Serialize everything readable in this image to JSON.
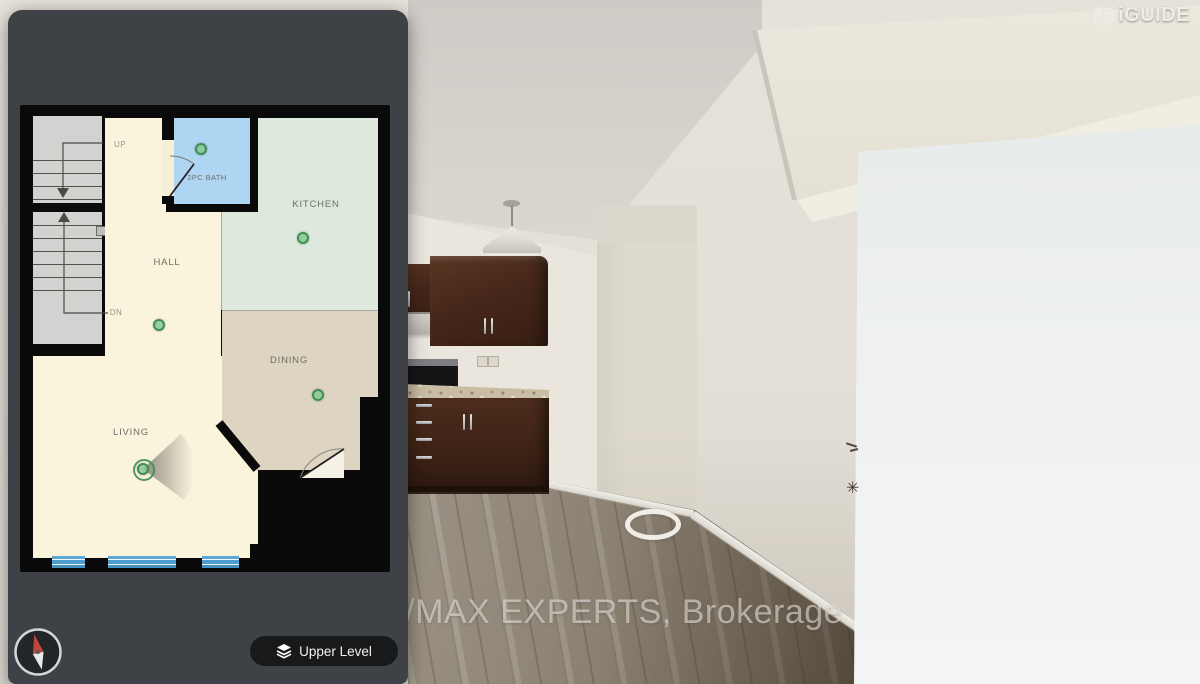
{
  "logo": {
    "brand": "iGUIDE"
  },
  "watermark": {
    "text": "RE/MAX EXPERTS, Brokerage"
  },
  "controls": {
    "level_button": {
      "label": "Upper Level",
      "icon": "layers-icon"
    },
    "compass": {
      "icon": "compass-needle-icon"
    }
  },
  "floorplan": {
    "current_level": "Upper Level",
    "rooms": {
      "kitchen": {
        "label": "KITCHEN"
      },
      "dining": {
        "label": "DINING"
      },
      "living": {
        "label": "LIVING"
      },
      "hall": {
        "label": "HALL"
      },
      "bath": {
        "label": "2PC BATH"
      }
    },
    "stairs": {
      "up": "UP",
      "down": "DN"
    },
    "markers": [
      {
        "room": "bath",
        "active": false
      },
      {
        "room": "kitchen",
        "active": false
      },
      {
        "room": "hall",
        "active": false
      },
      {
        "room": "dining",
        "active": false
      },
      {
        "room": "living",
        "active": true
      }
    ],
    "colors": {
      "hall_living": "#fbf4dc",
      "kitchen": "#dde9dd",
      "dining": "#ddd4c2",
      "bath": "#aed5f2",
      "stairs": "#d2d2d0",
      "wall": "#0a0a0a",
      "marker_green": "#86c794",
      "window_blue": "#5aa7d6",
      "panel_gray": "#3e4246"
    }
  }
}
